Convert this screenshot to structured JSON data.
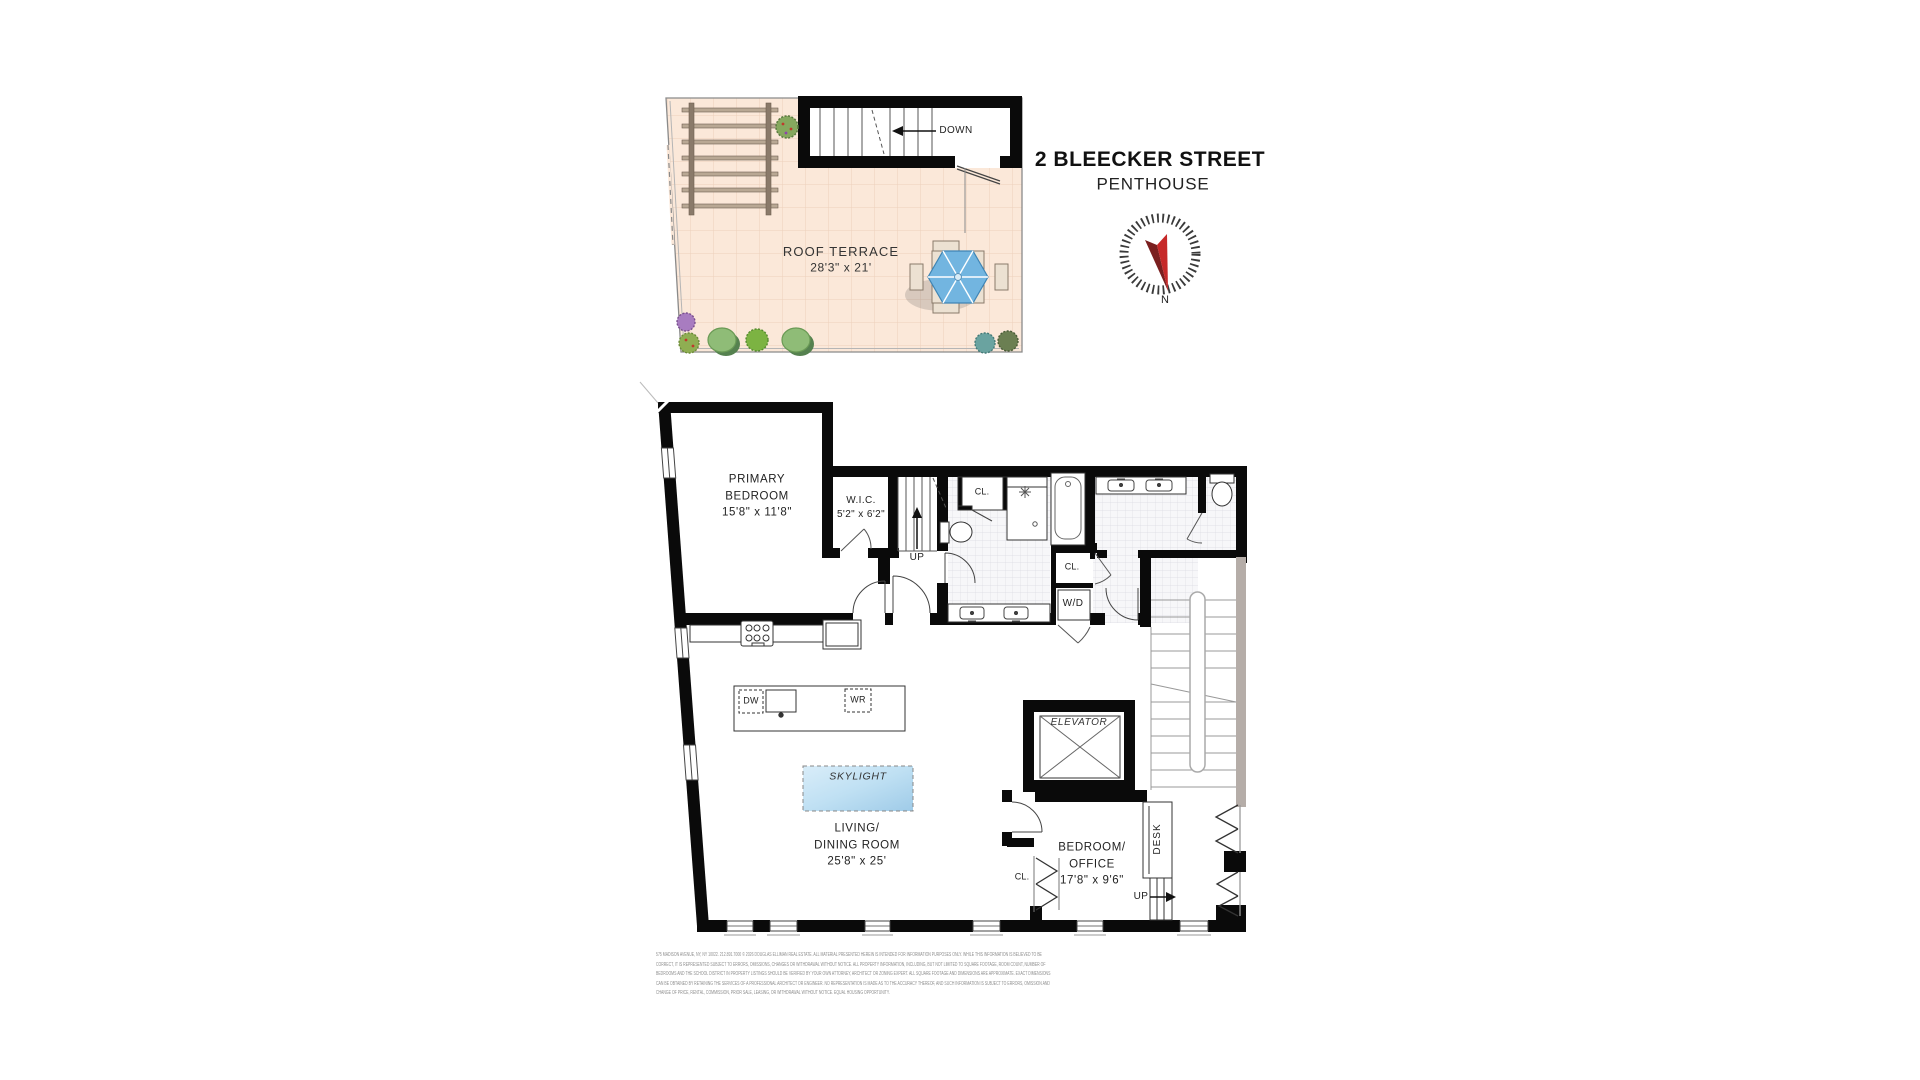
{
  "header": {
    "title": "2 BLEECKER STREET",
    "subtitle": "PENTHOUSE"
  },
  "compass": {
    "north_label": "N"
  },
  "roof_terrace": {
    "label": "ROOF TERRACE",
    "dims": "28'3\" x 21'",
    "stair_label": "DOWN"
  },
  "rooms": {
    "primary_bedroom": {
      "line1": "PRIMARY",
      "line2": "BEDROOM",
      "dims": "15'8\" x 11'8\""
    },
    "wic": {
      "label": "W.I.C.",
      "dims": "5'2\" x 6'2\""
    },
    "living_dining": {
      "line1": "LIVING/",
      "line2": "DINING ROOM",
      "dims": "25'8\" x 25'"
    },
    "bedroom_office": {
      "line1": "BEDROOM/",
      "line2": "OFFICE",
      "dims": "17'8\" x 9'6\""
    },
    "elevator": {
      "label": "ELEVATOR"
    },
    "skylight": {
      "label": "SKYLIGHT"
    }
  },
  "annotations": {
    "up_entry": "UP",
    "up_office": "UP",
    "closet_bath": "CL.",
    "closet_hall": "CL.",
    "closet_living": "CL.",
    "washer_dryer": "W/D",
    "dishwasher": "DW",
    "wine_cooler": "WR",
    "desk": "DESK"
  },
  "disclaimer_lines": [
    "575 MADISON AVENUE, NY, NY 10022. 212.891.7000 © 2026 DOUGLAS ELLIMAN REAL ESTATE. ALL MATERIAL PRESENTED HEREIN IS INTENDED FOR INFORMATION PURPOSES ONLY. WHILE THIS INFORMATION IS BELIEVED TO BE",
    "CORRECT, IT IS REPRESENTED SUBJECT TO ERRORS, OMISSIONS, CHANGES OR WITHDRAWAL WITHOUT NOTICE. ALL PROPERTY INFORMATION, INCLUDING, BUT NOT LIMITED TO SQUARE FOOTAGE, ROOM COUNT, NUMBER OF",
    "BEDROOMS AND THE SCHOOL DISTRICT IN PROPERTY LISTINGS SHOULD BE VERIFIED BY YOUR OWN ATTORNEY, ARCHITECT OR ZONING EXPERT. ALL SQUARE FOOTAGE AND DIMENSIONS ARE APPROXIMATE. EXACT DIMENSIONS",
    "CAN BE OBTAINED BY RETAINING THE SERVICES OF A PROFESSIONAL ARCHITECT OR ENGINEER. NO REPRESENTATION IS MADE AS TO THE ACCURACY THEREOF, AND SUCH INFORMATION IS SUBJECT TO ERRORS, OMISSION AND",
    "CHANGE OF PRICE, RENTAL, COMMISSION, PRIOR SALE, LEASING, OR WITHDRAWAL WITHOUT NOTICE. EQUAL HOUSING OPPORTUNITY."
  ],
  "colors": {
    "wall_black": "#0a0a0a",
    "terrace_floor": "#fbe8d9",
    "terrace_grid": "#ecd0bc",
    "bath_tile_grid": "#dcdce2",
    "skylight_blue": "#bfe0f3",
    "umbrella_blue": "#72b5e0",
    "compass_needle_red": "#c62828",
    "compass_needle_dark": "#7a1f1f",
    "stair_grey_wall": "#b5ada8",
    "disclaimer_grey": "#8d8d8d"
  }
}
